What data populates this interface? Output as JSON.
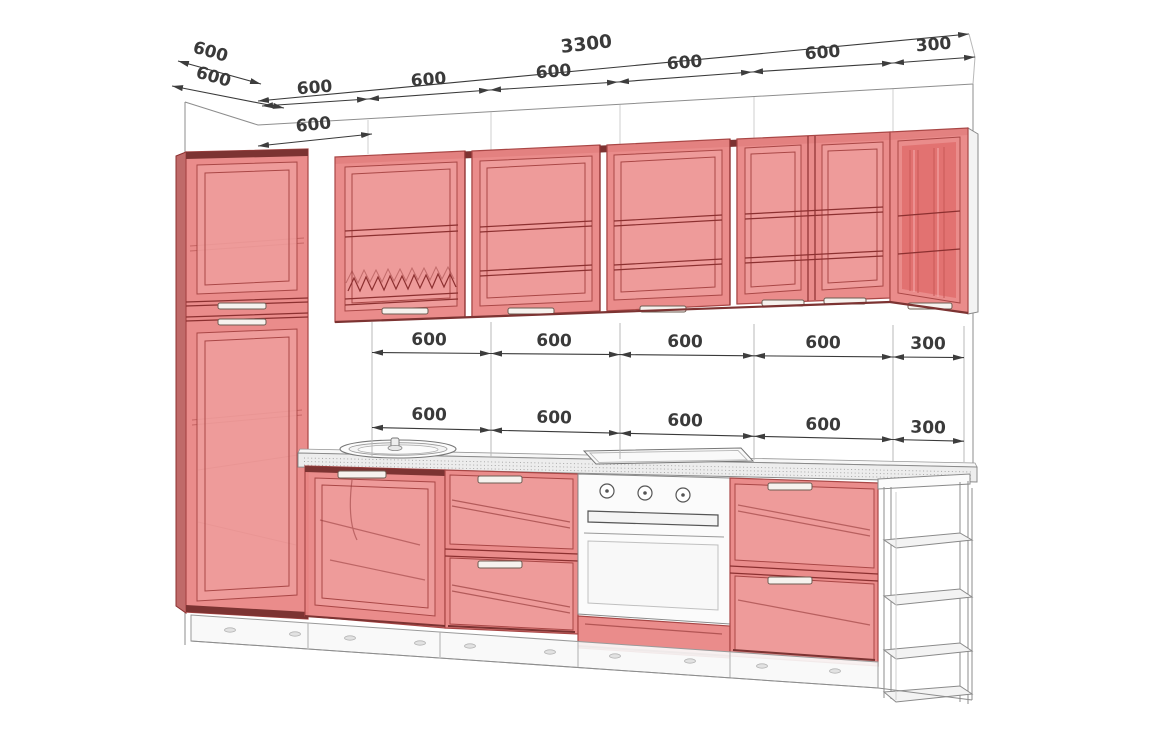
{
  "dims": {
    "overall": "3300",
    "top_chain": [
      "600",
      "600",
      "600",
      "600",
      "600",
      "300"
    ],
    "depth": [
      "600",
      "600"
    ],
    "tall_cabinet": "600",
    "row_upper": [
      "600",
      "600",
      "600",
      "600",
      "300"
    ],
    "row_lower": [
      "600",
      "600",
      "600",
      "600",
      "300"
    ]
  },
  "colors": {
    "bg": "#ffffff",
    "line": "#8d8d8d",
    "dim": "#3a3a3a",
    "red": "#e98685",
    "redlight": "#ef9d9c",
    "redline": "#a94746",
    "reddeep": "#8c3030",
    "reddark": "#7c3332",
    "glass": "#e27170",
    "handle": "#f6f2ee"
  }
}
